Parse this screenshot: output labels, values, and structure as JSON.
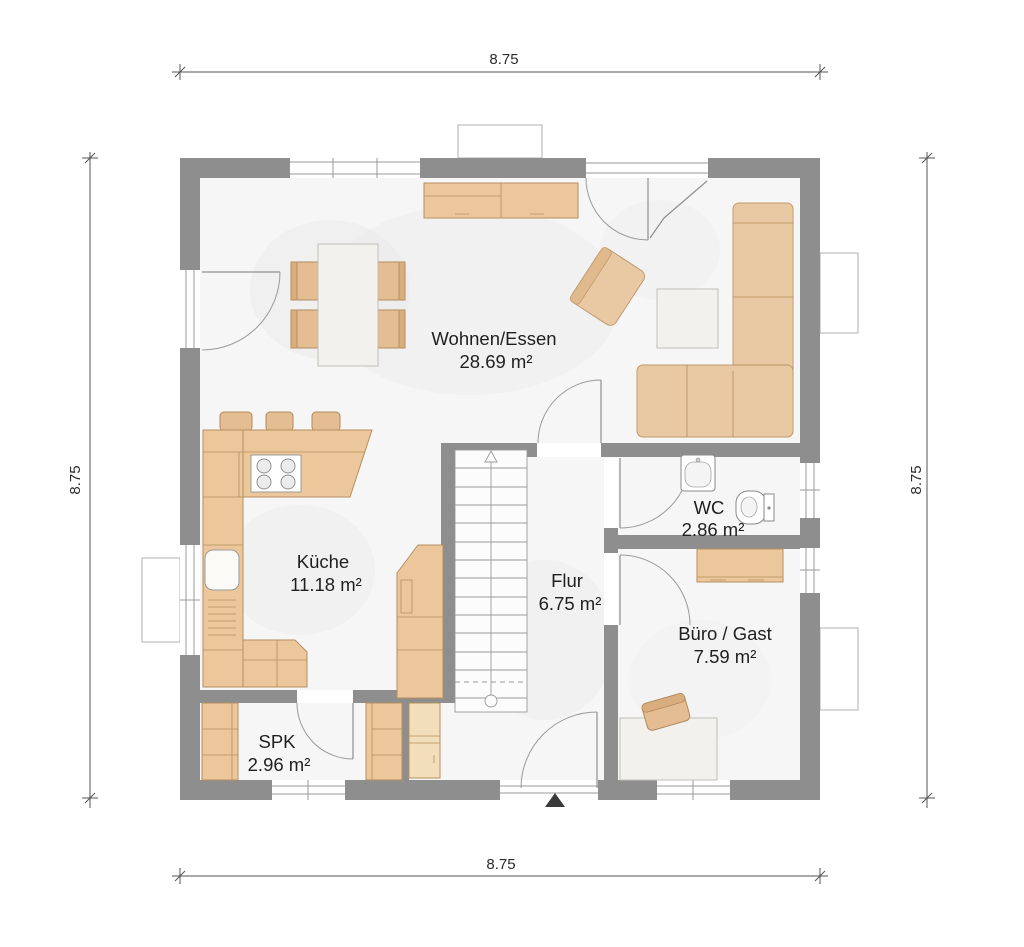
{
  "floor_plan": {
    "rooms": [
      {
        "name": "Wohnen/Essen",
        "area": "28.69 m²"
      },
      {
        "name": "Küche",
        "area": "11.18 m²"
      },
      {
        "name": "Flur",
        "area": "6.75 m²"
      },
      {
        "name": "WC",
        "area": "2.86 m²"
      },
      {
        "name": "Büro / Gast",
        "area": "7.59 m²"
      },
      {
        "name": "SPK",
        "area": "2.96 m²"
      }
    ],
    "dimensions": {
      "top": "8.75",
      "bottom": "8.75",
      "left": "8.75",
      "right": "8.75"
    },
    "icons": {
      "entrance": "entrance-arrow",
      "stairs_direction": "stairs-up-arrow"
    },
    "colors": {
      "wall": "#8e8e8e",
      "furniture": "#ebc79b",
      "furniture_dark": "#e4bd92",
      "sofa": "#e9c9a3",
      "floor": "#f6f6f6"
    }
  }
}
